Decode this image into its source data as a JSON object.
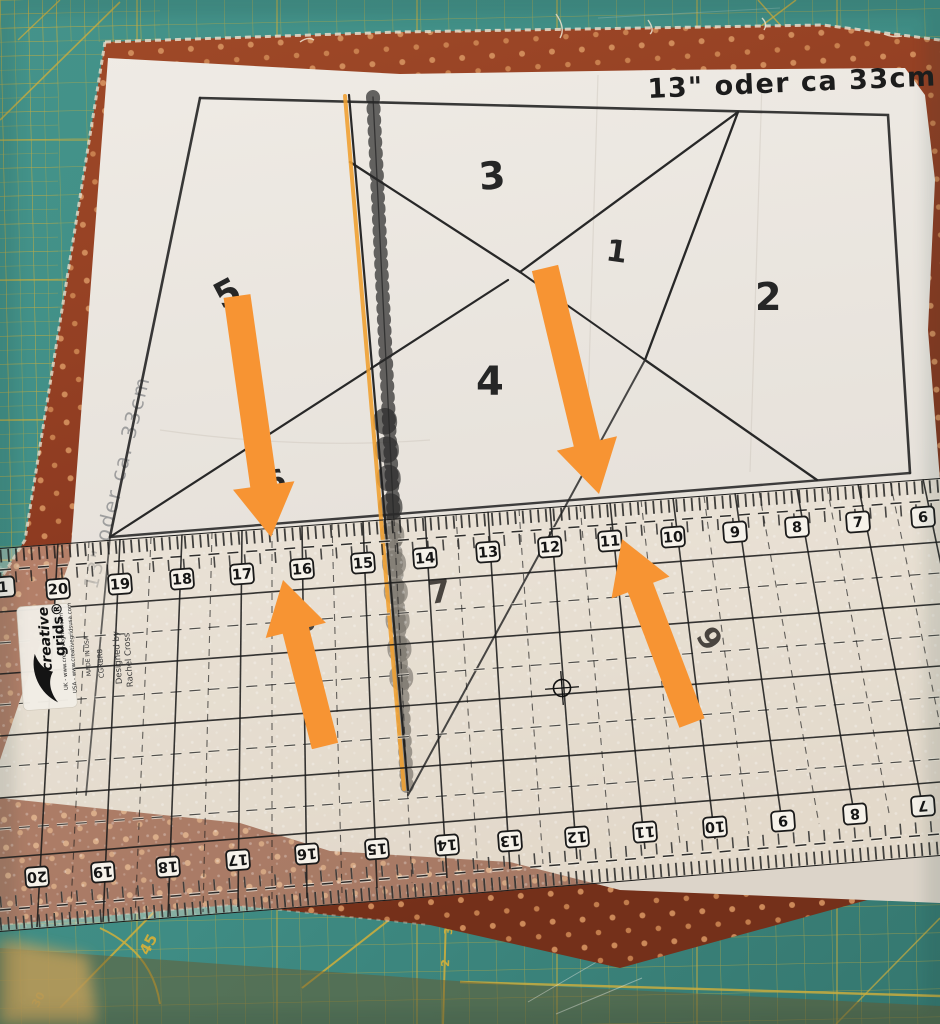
{
  "photo": {
    "annotations": {
      "top_right": "13\" oder ca 33cm",
      "left_side": "13\" oder ca. 33cm"
    },
    "pattern": {
      "pieces": [
        "1",
        "2",
        "3",
        "4",
        "5",
        "6",
        "7",
        "8",
        "9"
      ]
    },
    "ruler": {
      "brand_word1": "creative",
      "brand_word2": "grids®",
      "url_uk": "UK - www.creativegrids.com",
      "url_usa": "USA - www.creativegridsusa.com",
      "designer_line1": "Designed by",
      "designer_line2": "Rachel Cross",
      "product_code": "CGRBR8",
      "made_in": "MADE IN USA",
      "top_numbers": [
        "1",
        "20",
        "19",
        "18",
        "17",
        "16",
        "15",
        "14",
        "13",
        "12",
        "11",
        "10",
        "9",
        "8",
        "7",
        "6"
      ],
      "bottom_numbers": [
        "20",
        "19",
        "18",
        "17",
        "16",
        "15",
        "14",
        "13",
        "12",
        "11",
        "10",
        "9",
        "8",
        "7"
      ]
    },
    "mat": {
      "angle_45": "45",
      "label_30": "30",
      "edge_3": "3",
      "edge_2": "2"
    },
    "colors": {
      "mat_teal": "#3F8C84",
      "mat_grid_yellow": "#C9AD3E",
      "fabric_rust": "#8E3B21",
      "fabric_dot": "#D6935F",
      "paper": "#EAE6E0",
      "ink": "#2B2B2B",
      "pencil": "#9B9B9B",
      "arrow_orange": "#F79433",
      "thread_orange": "#F0A133"
    }
  }
}
